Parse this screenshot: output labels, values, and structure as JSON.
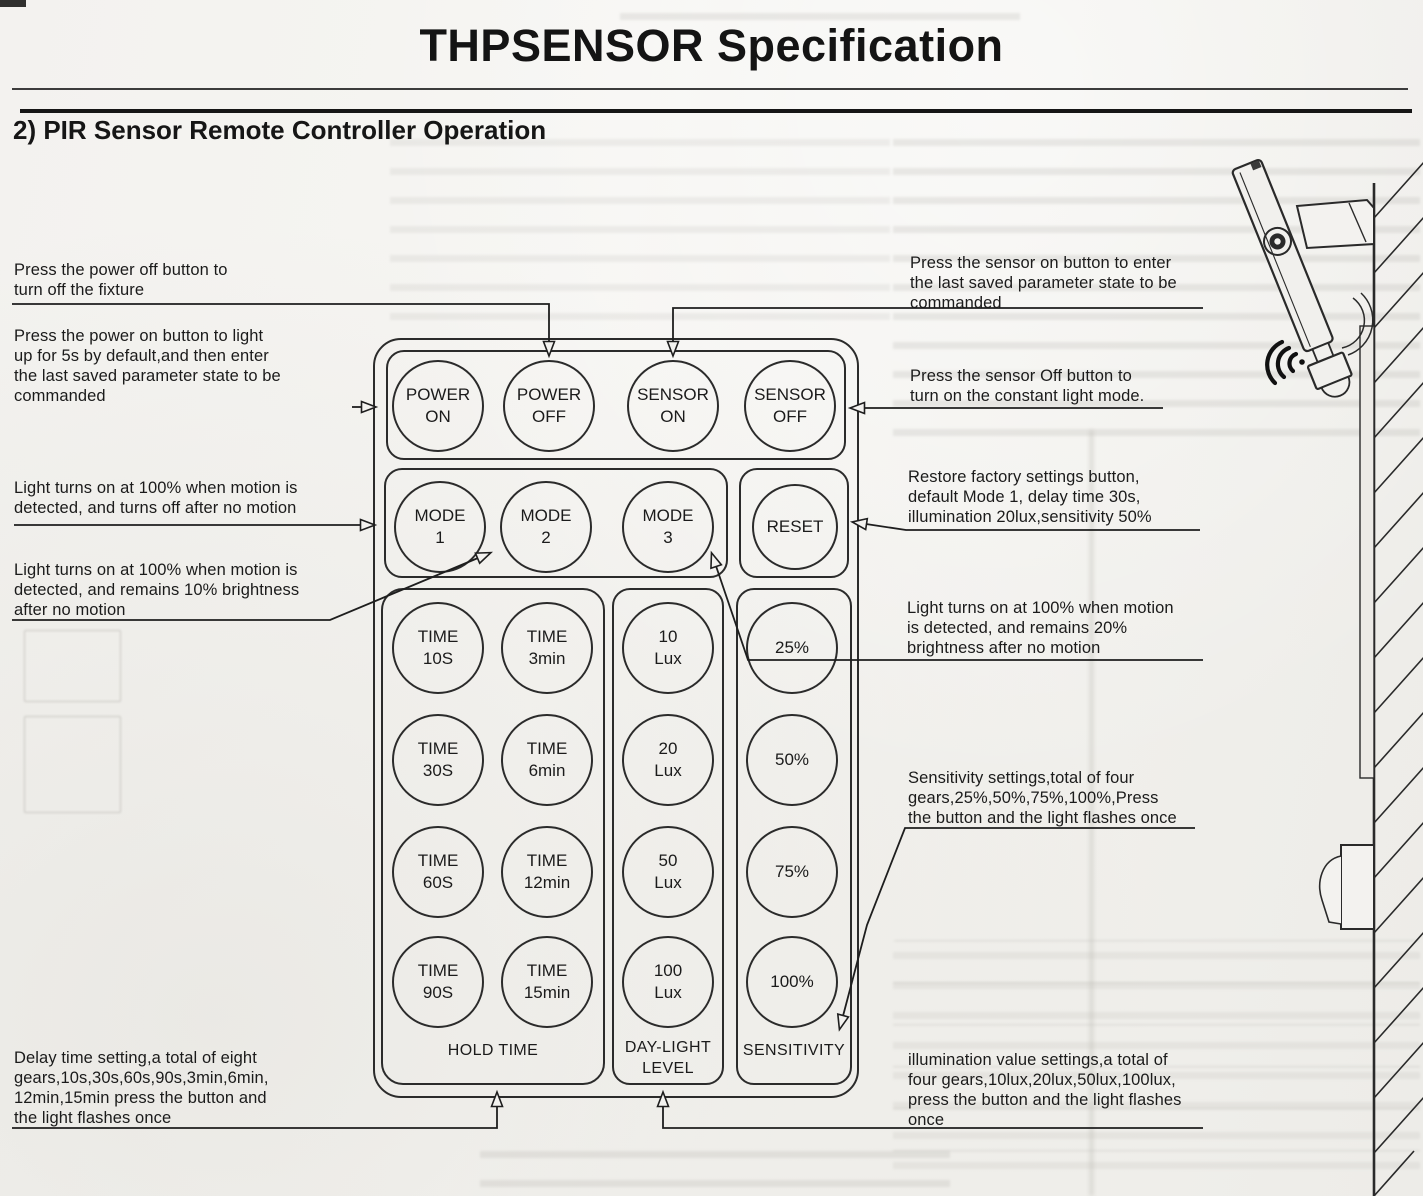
{
  "header": {
    "title": "THPSENSOR Specification",
    "section": "2) PIR Sensor Remote Controller Operation"
  },
  "remote": {
    "top_row": [
      {
        "l1": "POWER",
        "l2": "ON"
      },
      {
        "l1": "POWER",
        "l2": "OFF"
      },
      {
        "l1": "SENSOR",
        "l2": "ON"
      },
      {
        "l1": "SENSOR",
        "l2": "OFF"
      }
    ],
    "mode_row": [
      {
        "l1": "MODE",
        "l2": "1"
      },
      {
        "l1": "MODE",
        "l2": "2"
      },
      {
        "l1": "MODE",
        "l2": "3"
      }
    ],
    "reset": {
      "l1": "RESET"
    },
    "hold_time_grid": [
      [
        {
          "l1": "TIME",
          "l2": "10S"
        },
        {
          "l1": "TIME",
          "l2": "3min"
        }
      ],
      [
        {
          "l1": "TIME",
          "l2": "30S"
        },
        {
          "l1": "TIME",
          "l2": "6min"
        }
      ],
      [
        {
          "l1": "TIME",
          "l2": "60S"
        },
        {
          "l1": "TIME",
          "l2": "12min"
        }
      ],
      [
        {
          "l1": "TIME",
          "l2": "90S"
        },
        {
          "l1": "TIME",
          "l2": "15min"
        }
      ]
    ],
    "daylight_col": [
      {
        "l1": "10",
        "l2": "Lux"
      },
      {
        "l1": "20",
        "l2": "Lux"
      },
      {
        "l1": "50",
        "l2": "Lux"
      },
      {
        "l1": "100",
        "l2": "Lux"
      }
    ],
    "sensitivity_col": [
      {
        "l1": "25%"
      },
      {
        "l1": "50%"
      },
      {
        "l1": "75%"
      },
      {
        "l1": "100%"
      }
    ],
    "labels": {
      "hold_time": "HOLD TIME",
      "daylight": "DAY-LIGHT\nLEVEL",
      "sensitivity": "SENSITIVITY"
    }
  },
  "annotations": {
    "power_off": "Press the power off button to\nturn off the fixture",
    "power_on": "Press the power on button to light\nup for 5s by default,and then enter\nthe last saved parameter state to be\ncommanded",
    "mode1": "Light turns on at 100% when motion is\ndetected, and turns off after no motion",
    "mode2": "Light turns on at 100% when motion is\ndetected, and remains 10% brightness\nafter no motion",
    "delay": "Delay time setting,a total of eight\ngears,10s,30s,60s,90s,3min,6min,\n12min,15min press the button and\nthe light flashes once",
    "sensor_on": "Press the sensor on button to enter\nthe last saved parameter state to be\ncommanded",
    "sensor_off": "Press the sensor Off button to\nturn on the constant light mode.",
    "reset": "Restore factory settings button,\ndefault Mode 1, delay time 30s,\nillumination 20lux,sensitivity 50%",
    "mode3": "Light turns on at 100% when motion\nis detected, and remains 20%\nbrightness after no motion",
    "sensitivity": "Sensitivity settings,total of four\ngears,25%,50%,75%,100%,Press\nthe button and the light flashes once",
    "illumination": "illumination value settings,a total of\nfour gears,10lux,20lux,50lux,100lux,\npress the button and the light flashes\nonce"
  }
}
